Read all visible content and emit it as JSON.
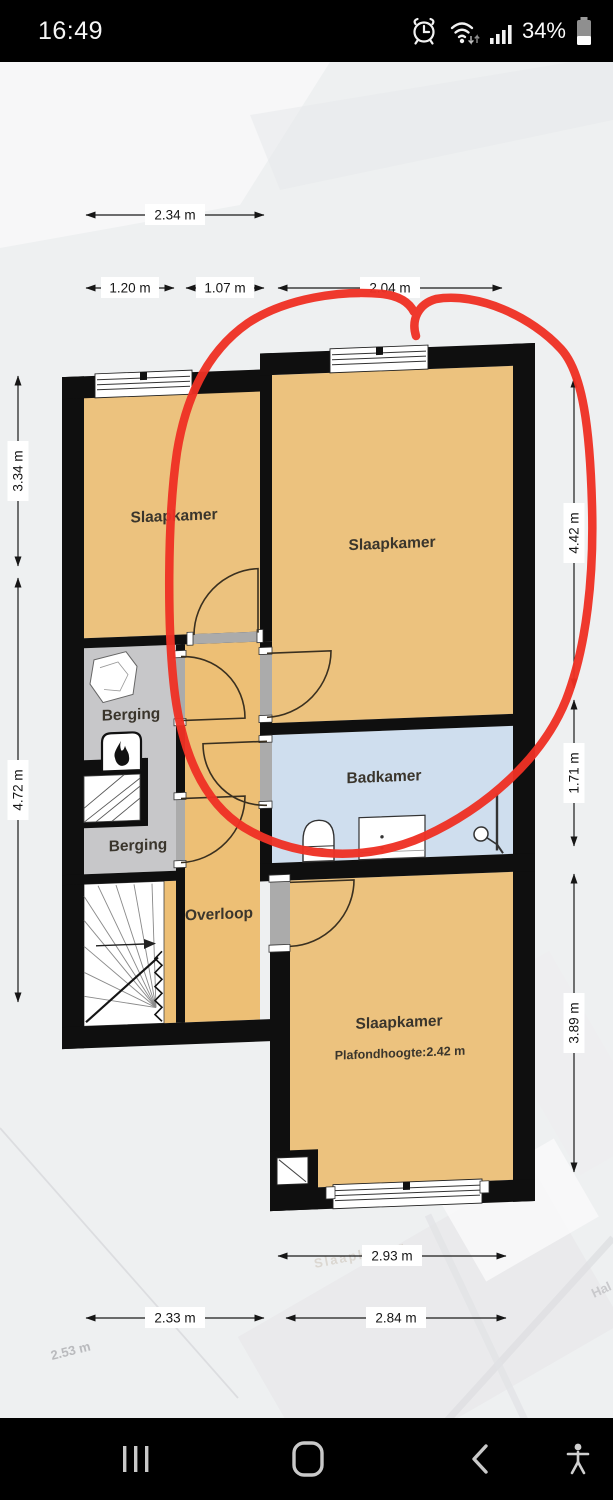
{
  "status_bar": {
    "time": "16:49",
    "battery_percent": "34%",
    "icons": [
      "alarm-icon",
      "wifi-icon",
      "signal-strength-icon",
      "battery-icon"
    ]
  },
  "floorplan": {
    "rooms": [
      {
        "label": "Slaapkamer"
      },
      {
        "label": "Slaapkamer"
      },
      {
        "label": "Berging"
      },
      {
        "label": "Berging"
      },
      {
        "label": "Badkamer"
      },
      {
        "label": "Overloop"
      },
      {
        "label": "Slaapkamer",
        "ceiling_note": "Plafondhoogte:2.42 m"
      }
    ],
    "dimensions": {
      "top": [
        "2.34 m",
        "1.20 m",
        "1.07 m",
        "2.04 m"
      ],
      "left": [
        "3.34 m",
        "4.72 m"
      ],
      "right": [
        "4.42 m",
        "1.71 m",
        "3.89 m"
      ],
      "bottom": [
        "2.93 m",
        "2.33 m",
        "2.84 m"
      ],
      "ghost": [
        "2.53 m",
        "Slaapkamer",
        "Hal"
      ]
    },
    "fixtures": [
      "stairs",
      "fireplace",
      "toilet",
      "vanity",
      "shower"
    ],
    "annotation": {
      "shape": "hand-drawn-circle",
      "color": "#ee3124"
    }
  },
  "nav_bar": {
    "icons": [
      "recents-icon",
      "home-icon",
      "back-icon",
      "accessibility-icon"
    ]
  },
  "colors": {
    "room_fill": "#ecc27e",
    "bathroom_fill": "#cfdeee",
    "storage_fill": "#c7c7c9",
    "wall": "#0f0f0f",
    "background": "#eef0f1",
    "annotation_red": "#ee3124",
    "bar_bg": "#000000"
  }
}
